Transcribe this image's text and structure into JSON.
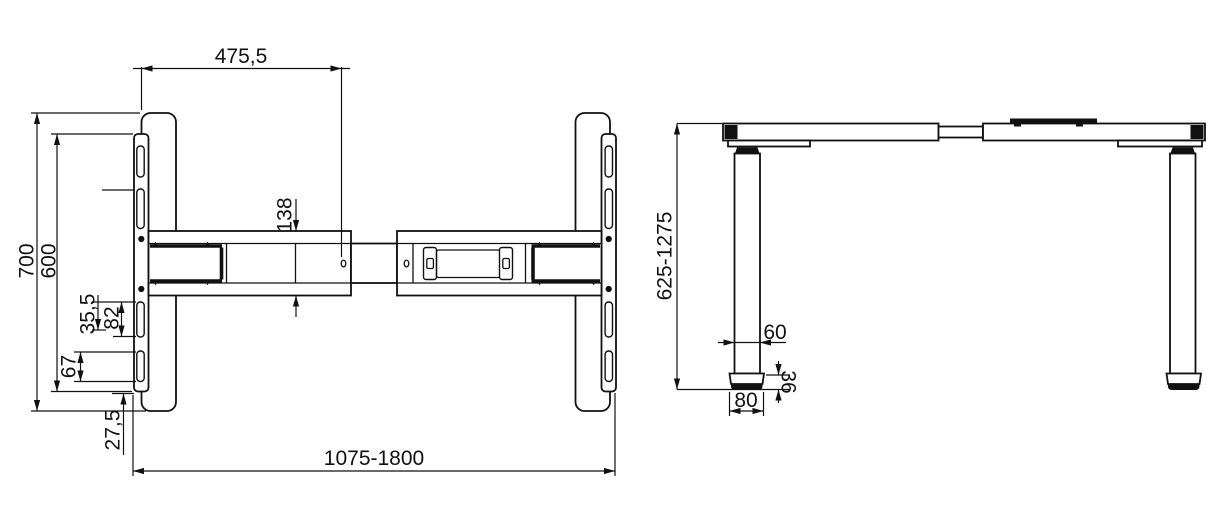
{
  "drawing": {
    "background": "#ffffff",
    "line_color": "#111111",
    "top_view": {
      "dims": {
        "beam_section_offset": "475,5",
        "foot_length": "700",
        "bracket_length": "600",
        "beam_width": "138",
        "slot_gap": "35,5",
        "upper_slot_length": "82",
        "lower_slot_length": "67",
        "bracket_end_offset": "27,5",
        "frame_width_range": "1075-1800"
      }
    },
    "side_view": {
      "dims": {
        "height_range": "625-1275",
        "leg_width": "60",
        "foot_height": "36",
        "foot_width": "80"
      }
    }
  }
}
